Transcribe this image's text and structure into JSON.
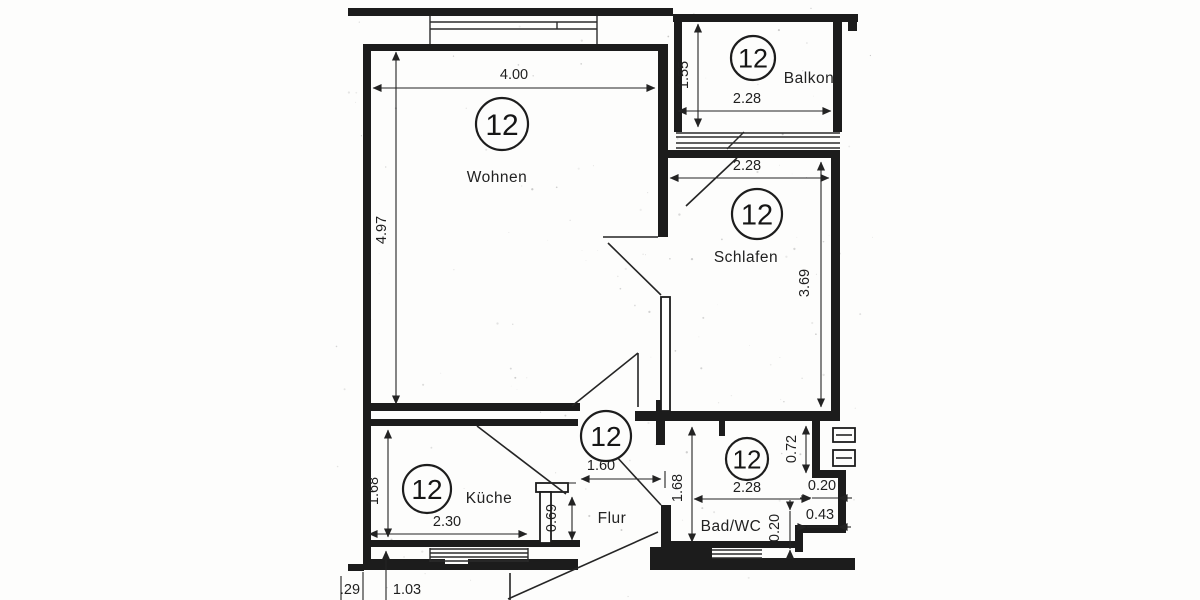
{
  "unit_number": "12",
  "rooms": {
    "wohnen": {
      "number": "12",
      "label": "Wohnen"
    },
    "balkon": {
      "number": "12",
      "label": "Balkon"
    },
    "schlafen": {
      "number": "12",
      "label": "Schlafen"
    },
    "kueche": {
      "number": "12",
      "label": "Küche"
    },
    "flur": {
      "number": "12",
      "label": "Flur"
    },
    "badwc": {
      "number": "12",
      "label": "Bad/WC"
    }
  },
  "dims": {
    "wohnen_width": "4.00",
    "wohnen_height": "4.97",
    "balkon_depth": "1.55",
    "balkon_width": "2.28",
    "schlafen_width": "2.28",
    "schlafen_height": "3.69",
    "kueche_height": "1.68",
    "kueche_width": "2.30",
    "kueche_niche": "0.69",
    "flur_width": "1.60",
    "badwc_height": "1.68",
    "badwc_width": "2.28",
    "badwc_recess": "0.72",
    "badwc_step_top": "0.20",
    "badwc_step_right": "0.43",
    "badwc_step_bottom": "0.20",
    "entry_step": ".29",
    "entry_width": "1.03"
  },
  "colors": {
    "ink": "#1c1c1c",
    "paper": "#fdfdfc"
  }
}
